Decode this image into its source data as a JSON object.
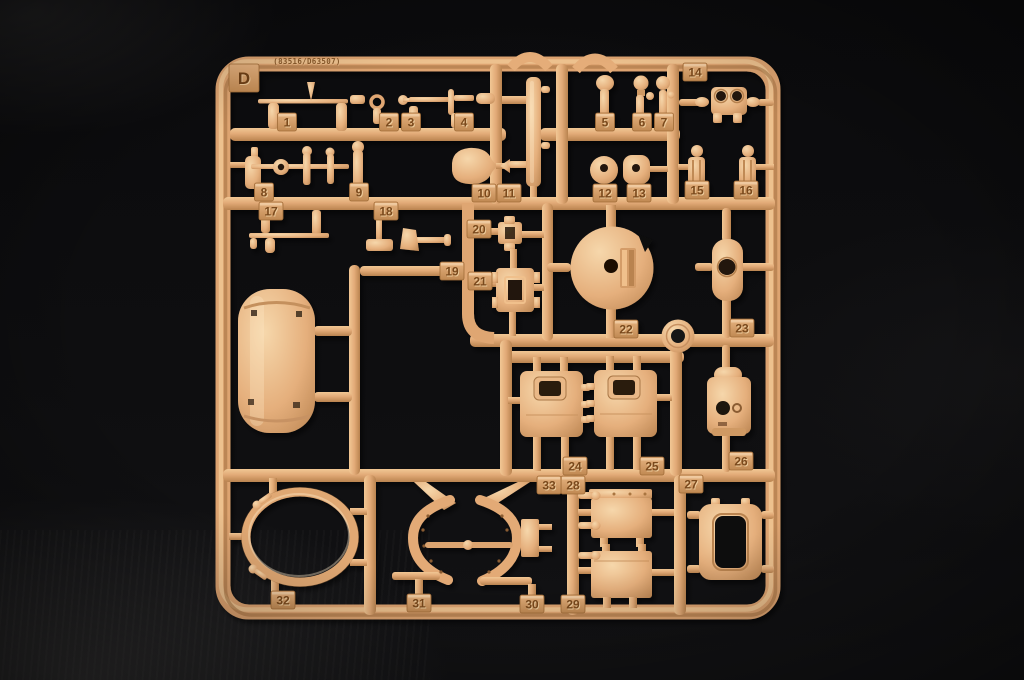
{
  "meta": {
    "scene": "Photograph of a tan plastic injection-molded model-kit sprue (parts tree) lying on a dark background",
    "plastic_color_base": "#dfa572",
    "plastic_color_highlight": "#f2cb97",
    "plastic_color_shadow": "#8a5a30",
    "background_color": "#0c0c0e"
  },
  "sprue": {
    "letter": "D",
    "mold_code": "(83516/D63507)",
    "part_count": 33,
    "part_labels": [
      {
        "n": "1",
        "x": 287,
        "y": 122
      },
      {
        "n": "2",
        "x": 389,
        "y": 122
      },
      {
        "n": "3",
        "x": 411,
        "y": 122
      },
      {
        "n": "4",
        "x": 464,
        "y": 122
      },
      {
        "n": "5",
        "x": 605,
        "y": 122
      },
      {
        "n": "6",
        "x": 642,
        "y": 122
      },
      {
        "n": "7",
        "x": 664,
        "y": 122
      },
      {
        "n": "8",
        "x": 264,
        "y": 192
      },
      {
        "n": "9",
        "x": 359,
        "y": 192
      },
      {
        "n": "10",
        "x": 484,
        "y": 193
      },
      {
        "n": "11",
        "x": 509,
        "y": 193
      },
      {
        "n": "12",
        "x": 605,
        "y": 193
      },
      {
        "n": "13",
        "x": 639,
        "y": 193
      },
      {
        "n": "14",
        "x": 695,
        "y": 72
      },
      {
        "n": "15",
        "x": 697,
        "y": 190
      },
      {
        "n": "16",
        "x": 746,
        "y": 190
      },
      {
        "n": "17",
        "x": 271,
        "y": 211
      },
      {
        "n": "18",
        "x": 386,
        "y": 211
      },
      {
        "n": "19",
        "x": 452,
        "y": 271
      },
      {
        "n": "20",
        "x": 479,
        "y": 229
      },
      {
        "n": "21",
        "x": 480,
        "y": 281
      },
      {
        "n": "22",
        "x": 626,
        "y": 329
      },
      {
        "n": "23",
        "x": 742,
        "y": 328
      },
      {
        "n": "24",
        "x": 575,
        "y": 466
      },
      {
        "n": "25",
        "x": 652,
        "y": 466
      },
      {
        "n": "26",
        "x": 741,
        "y": 461
      },
      {
        "n": "27",
        "x": 691,
        "y": 484
      },
      {
        "n": "28",
        "x": 573,
        "y": 485
      },
      {
        "n": "29",
        "x": 573,
        "y": 604
      },
      {
        "n": "30",
        "x": 532,
        "y": 604
      },
      {
        "n": "31",
        "x": 419,
        "y": 603
      },
      {
        "n": "32",
        "x": 283,
        "y": 600
      },
      {
        "n": "33",
        "x": 549,
        "y": 485
      }
    ]
  }
}
